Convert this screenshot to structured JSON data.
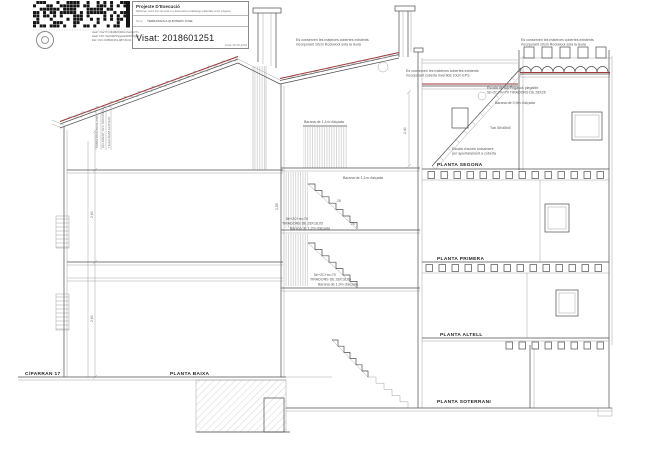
{
  "stamp": {
    "project_title": "Projecte D'Execució",
    "project_desc": "Reforma i canvi d'ús de local en planta baixa a habitatge unifamiliar entre mitgeres",
    "name_label": "Nom:",
    "name_value": "TERRASSOLA QUINTERO JOSE",
    "visat_text": "Visat: 2018601251",
    "date": "Data: 08-05-2018",
    "hash_line1": "Hash: h4wYTmSFpBZQbWmUwo9gV7n",
    "hash_line2": "Hash CSV: 5wjXsRPPkgqwd3XWT6Qj8v",
    "hash_line3": "Ref: CSV 2018601251-ABT-59-61"
  },
  "drawing": {
    "floor_labels": {
      "segona": "PLANTA SEGONA",
      "primera": "PLANTA PRIMERA",
      "altell": "PLANTA ALTELL",
      "baixa": "PLANTA BAIXA",
      "soterrani": "PLANTA SOTERRANI"
    },
    "street_label": "C/PARRAN 17",
    "notes": {
      "roof_left": [
        "Es conserven les mateixes cobertes existents",
        "incorporant 10cm Rockwool sota la teula"
      ],
      "roof_center": [
        "Es conserven les mateixes cobertes existents",
        "incorporant coberta invertida 10cm EPS"
      ],
      "roof_right": [
        "Es conserven les mateixes cobertes existents",
        "incorporant 10cm Rockwool sota la teula"
      ],
      "pegasus": [
        "Escala de tub Pegasus plegable",
        "5è+2C+m=70  TIRADORS DE 28X26",
        "Barana de 0,9m d'alçada"
      ],
      "tub": "Tub 50x80x5",
      "acces": [
        "Escala d'accés únicament",
        "per apuntalament a coberta"
      ],
      "barana11a": "Barana de 1,1m d'alçada",
      "barana11b": "Barana de 1,1m d'alçada",
      "stair_mid": [
        "5è+2C+m=70",
        "TIRADORS DE 28X18,05",
        "Barana de 1,2m d'alçada"
      ],
      "stair_low": [
        "5è+2C+m=70",
        "TIRADORS DE 28X18,05",
        "Barana de 1,0m d'alçada"
      ],
      "roof_detail": [
        "CANAL OCULTA DE ZINC",
        "AÏLLAMENT 10cm ROCKWOOL",
        "TEULA ÀRAB EXISTENT"
      ]
    },
    "dims": {
      "h240": "2,40",
      "h260a": "2,60",
      "h260b": "2,60",
      "h285": "2,85",
      "t28": "28",
      "t25": "25"
    }
  }
}
